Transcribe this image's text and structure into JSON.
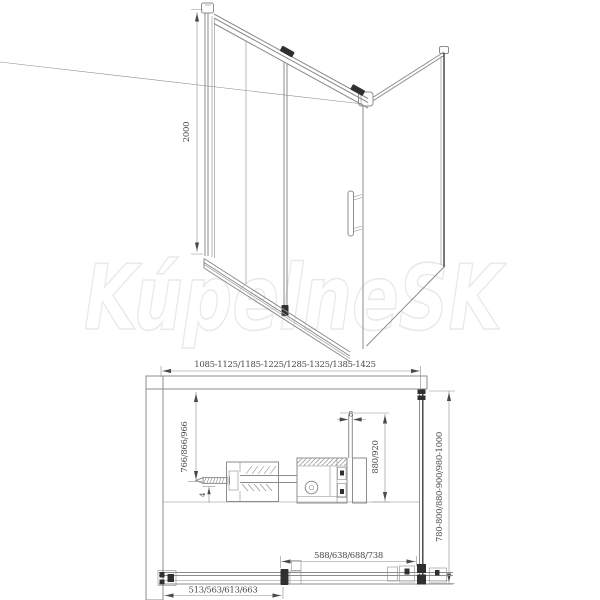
{
  "watermark": {
    "text": "KúpelneSK"
  },
  "colors": {
    "line": "#8c8c8c",
    "line_dark": "#303030",
    "text": "#4a4a4a",
    "brick": "#b0b0b0",
    "watermark": "#e9e9e9",
    "background": "#ffffff"
  },
  "front_view": {
    "height_dim": "2000"
  },
  "plan_view": {
    "width_dim": "1085-1125/1185-1225/1285-1325/1385-1425",
    "depth_dim": "780-800/880-900/980-1000",
    "door_glass_dim": "880/920",
    "glass_thickness_dim": "8",
    "fixed_glass_dim": "766/866/966",
    "gap_dim": "4",
    "door_width_dim": "588/638/688/738",
    "entry_width_dim": "513/563/613/663"
  }
}
